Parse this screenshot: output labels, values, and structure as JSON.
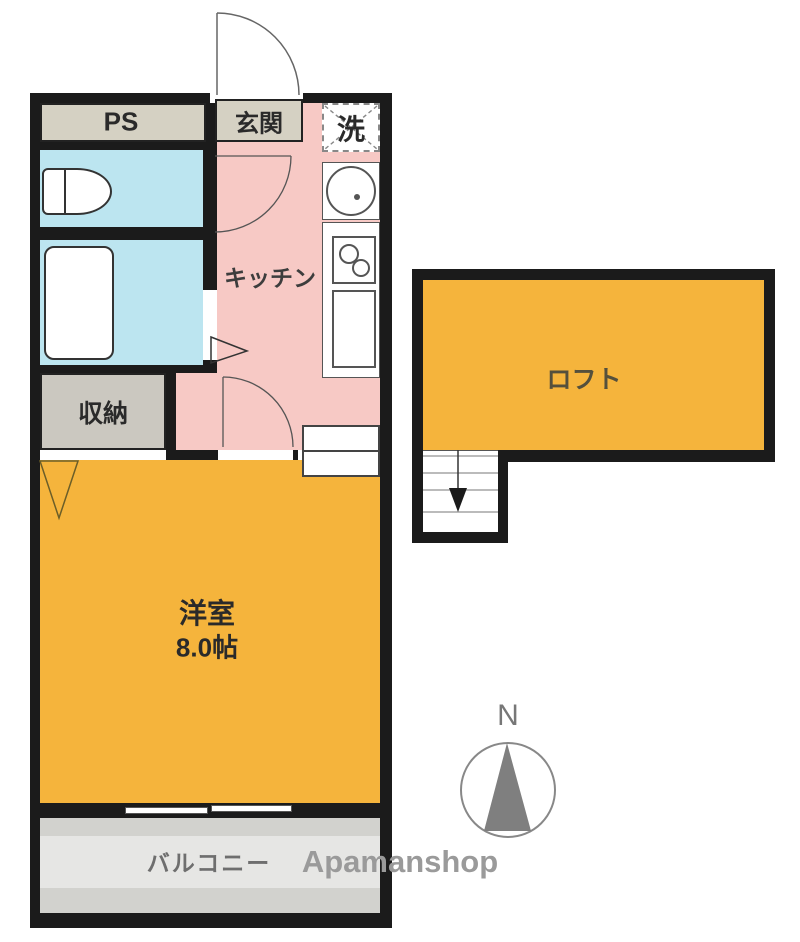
{
  "floorplan": {
    "rooms": {
      "ps": {
        "label": "PS"
      },
      "entrance": {
        "label": "玄関"
      },
      "laundry": {
        "label": "洗"
      },
      "kitchen": {
        "label": "キッチン"
      },
      "storage": {
        "label": "収納"
      },
      "western_room": {
        "label": "洋室",
        "size": "8.0帖"
      },
      "loft": {
        "label": "ロフト"
      },
      "balcony": {
        "label": "バルコニー"
      }
    },
    "compass": {
      "north_label": "N"
    },
    "watermark": "Apamanshop",
    "colors": {
      "wall_black": "#1b1b1b",
      "room_orange": "#f5b43c",
      "kitchen_pink": "#f7c9c5",
      "wet_area_blue": "#bce5f0",
      "service_beige": "#d5d1c3",
      "storage_gray": "#cbc8c0",
      "balcony_gray": "#d2d2ce",
      "watermark_gray": "#9a9a9a"
    }
  }
}
